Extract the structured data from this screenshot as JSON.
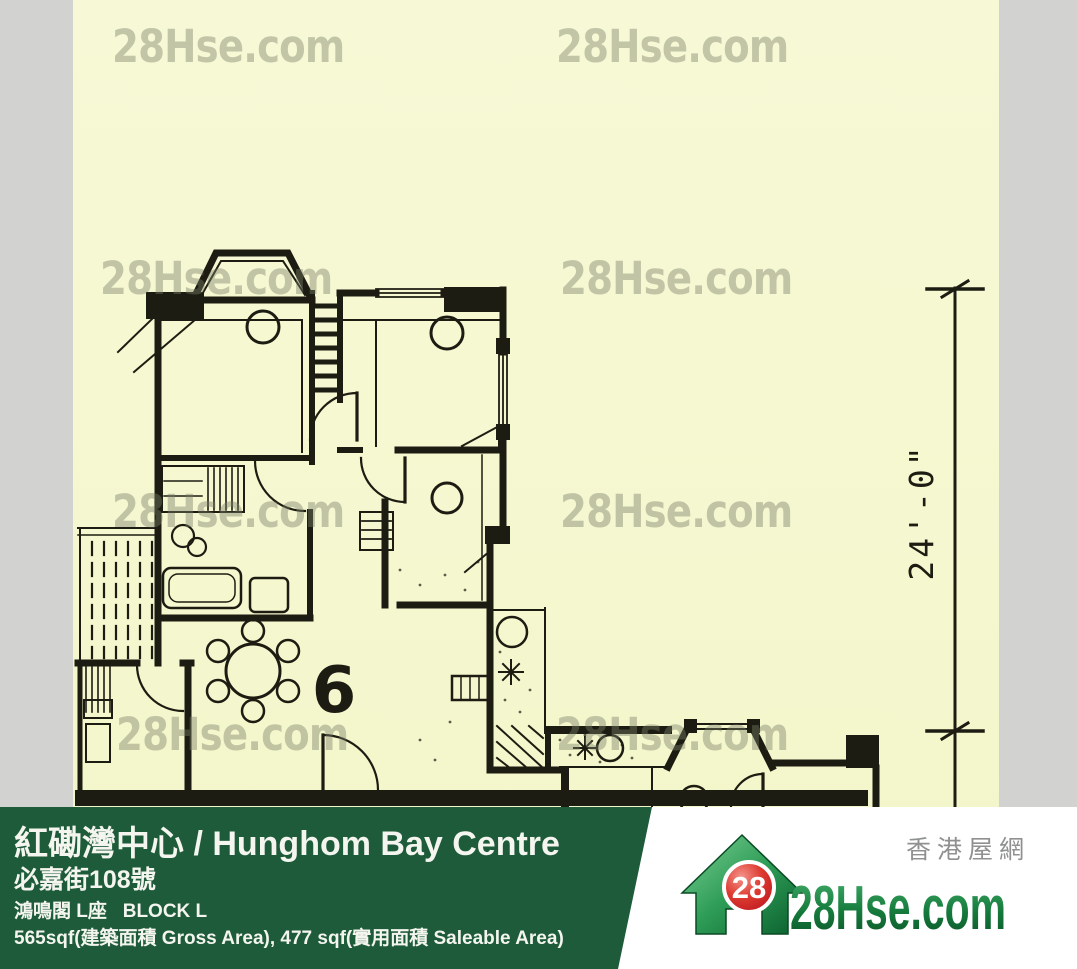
{
  "watermark": {
    "text": "28Hse.com"
  },
  "plan": {
    "room_number": "6",
    "dimension_label": "24'-0\""
  },
  "footer": {
    "title": "紅磡灣中心 / Hunghom Bay Centre",
    "address": "必嘉街108號",
    "block_name": "鴻鳴閣 L座   BLOCK L",
    "area": "565sqf(建築面積 Gross Area), 477 sqf(實用面積 Saleable Area)"
  },
  "logo": {
    "badge": "28",
    "brand": "28Hse.com",
    "tagline": "香港屋網"
  },
  "colors": {
    "banner_green": "#1e5b3a",
    "paper": "#f5f7cf",
    "ink": "#1d1c12",
    "logo_green": "#157a3c",
    "logo_red": "#cc1f26",
    "gray_margin": "#d2d2d0",
    "watermark_gray": "#7d8266"
  }
}
